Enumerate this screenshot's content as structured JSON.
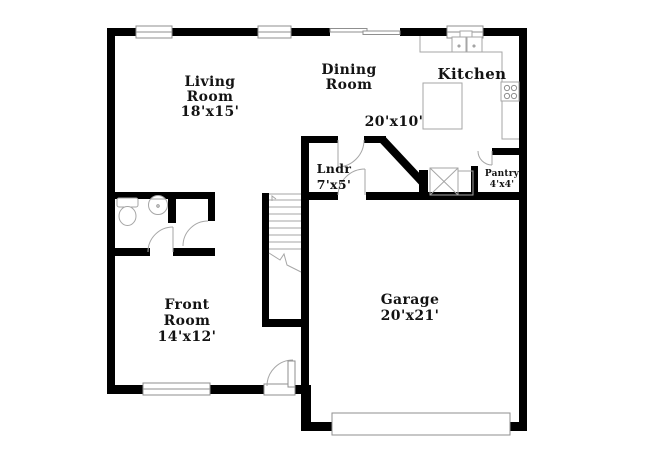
{
  "title": "Floor plan - first floor",
  "colors": {
    "wall": "#000000",
    "fixture_line": "#a6a6a6",
    "text": "#131313",
    "background": "#ffffff"
  },
  "rooms": {
    "living": {
      "line1": "Living",
      "line2": "Room",
      "dims": "18'x15'"
    },
    "dining": {
      "line1": "Dining",
      "line2": "Room",
      "dims": "20'x10'"
    },
    "kitchen": {
      "name": "Kitchen"
    },
    "laundry": {
      "name": "Lndr",
      "dims": "7'x5'"
    },
    "pantry": {
      "name": "Pantry",
      "dims": "4'x4'"
    },
    "garage": {
      "name": "Garage",
      "dims": "20'x21'"
    },
    "front_room": {
      "line1": "Front",
      "line2": "Room",
      "dims": "14'x12'"
    }
  },
  "fixtures": [
    "window",
    "sliding-door",
    "kitchen-sink",
    "kitchen-counter",
    "kitchen-island",
    "stove",
    "hvac-unit",
    "stairs",
    "toilet",
    "bathroom-sink",
    "interior-door",
    "front-door",
    "garage-door"
  ]
}
